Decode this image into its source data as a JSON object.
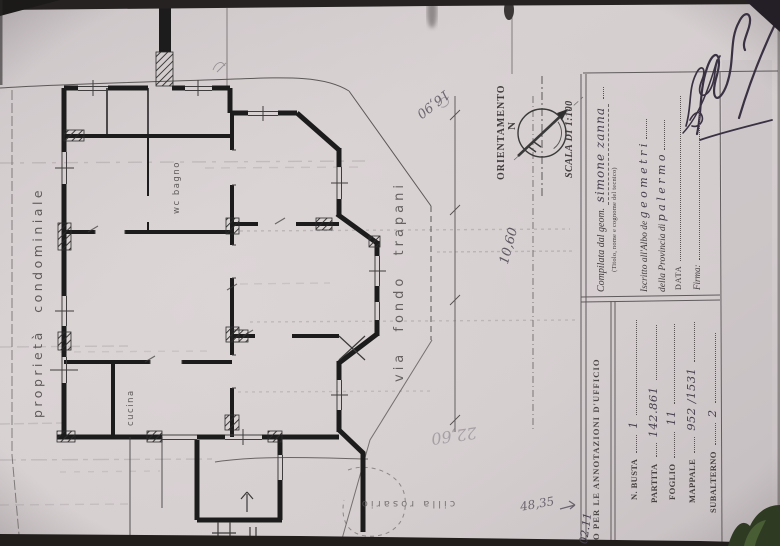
{
  "photo": {
    "background": "#1d1a18",
    "paper_color": "#d2cbcc",
    "ink_color": "#3a3142",
    "pencil_color": "#6e6670",
    "wall_color": "#1c1c1c",
    "leaf_color": "#2e3b22"
  },
  "plan": {
    "boundary_label": "proprietà condominiale",
    "street_label": "via fondo trapani",
    "room_wc_label": "wc bagno",
    "room_kitchen_label": "cucina",
    "bottom_name": "cilla rosario",
    "orientation_label": "ORIENTAMENTO",
    "north_letter": "N",
    "scale_label": "SCALA DI 1:100",
    "dims": {
      "d1": "16,90",
      "d2": "10,60",
      "d3": "22,60",
      "d4": "48,35"
    },
    "corner_note": "02.11"
  },
  "title_block": {
    "compiled_label": "Compilata dal geom.",
    "compiled_value": "simone zanna",
    "compiled_note": "(Titolo, nome e cognome del tecnico)",
    "albo_label": "Iscritto all'Albo de",
    "albo_value": "g e o m e t r i",
    "province_label": "della Provincia di",
    "province_value": "p a l e r m o",
    "date_label": "DATA",
    "signature_label": "Firma:"
  },
  "office_box": {
    "header": "O PER LE ANNOTAZIONI D'UFFICIO",
    "fields": [
      {
        "label": "N. BUSTA",
        "value": "1"
      },
      {
        "label": "PARTITA",
        "value": "142.861"
      },
      {
        "label": "FOGLIO",
        "value": "11"
      },
      {
        "label": "MAPPALE",
        "value": "952 /1531"
      },
      {
        "label": "SUBALTERNO",
        "value": "2"
      }
    ]
  }
}
